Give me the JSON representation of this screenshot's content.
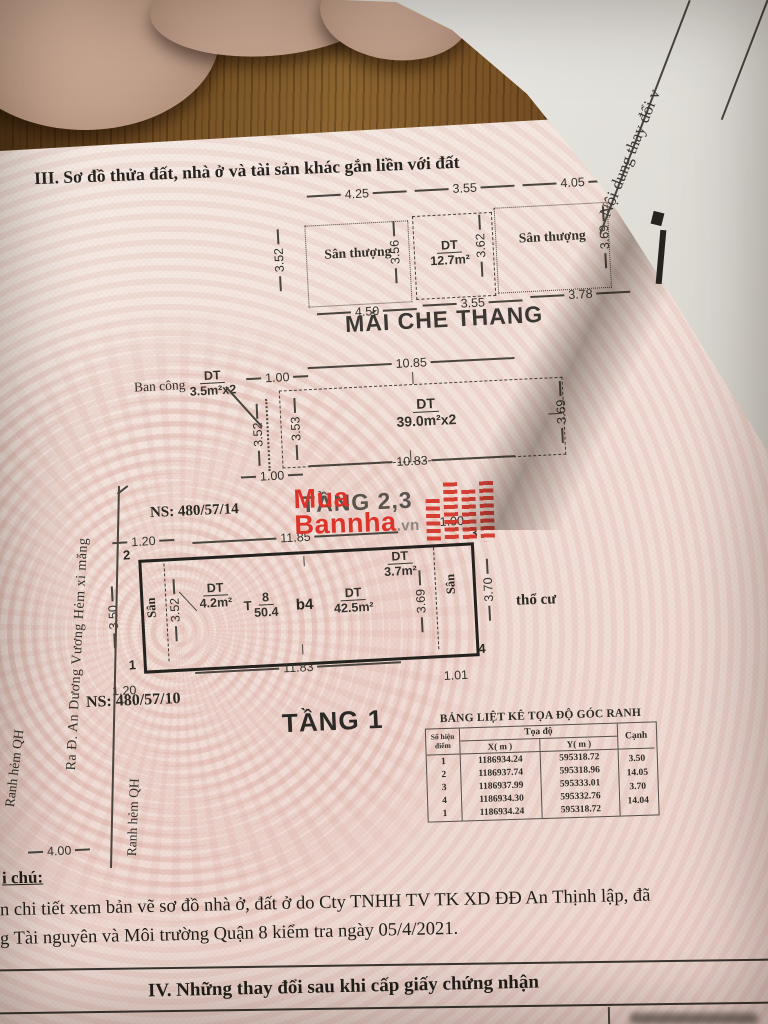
{
  "photo": {
    "next_page_vertical_text": "Nội dung thay đổi v"
  },
  "doc": {
    "section3_title": "III. Sơ đồ thửa đất, nhà ở và tài sản khác gắn liền với đất",
    "section4_title": "IV. Những thay đổi sau khi cấp giấy chứng nhận",
    "note_label": "i chú:",
    "note_line1": "n chi tiết xem bản vẽ sơ đồ nhà ở, đất ở do Cty TNHH TV TK XD ĐĐ An Thịnh lập, đã",
    "note_line2": "g Tài nguyên và Môi trường Quận 8 kiểm tra ngày 05/4/2021."
  },
  "roof": {
    "title": "MÁI CHE THANG",
    "left_label": "Sân thượng",
    "right_label": "Sân thượng",
    "dt": "DT",
    "area": "12.7m²",
    "d_top_left": "4.25",
    "d_top_mid": "3.55",
    "d_top_right": "4.05",
    "d_left": "3.52",
    "d_mid_left": "3.56",
    "d_mid_right": "3.62",
    "d_right": "3.69",
    "d_bot_left": "4.50",
    "d_bot_mid": "3.55",
    "d_bot_right": "3.78"
  },
  "floor23": {
    "title": "TẦNG 2,3",
    "balcony": "Ban công",
    "dt": "DT",
    "balcony_area": "3.5m²x2",
    "area": "39.0m²x2",
    "d_top_offset": "1.00",
    "d_top": "10.85",
    "d_left_outer": "3.52",
    "d_left_inner": "3.53",
    "d_right": "3.69",
    "d_bottom": "10.83",
    "d_bottom_offset": "1.00"
  },
  "floor1": {
    "title": "TẦNG 1",
    "ns_top": "NS: 480/57/14",
    "ns_bottom": "NS: 480/57/10",
    "land_type": "thổ cư",
    "street": "Ra Đ. An Dương Vương  Hẻm xi măng",
    "ranh1": "Ranh hẻm QH",
    "ranh2": "Ranh hẻm QH",
    "alley_w": "4.00",
    "san_left": "Sân",
    "san_right": "Sân",
    "dt": "DT",
    "area_left": "4.2m²",
    "house_no_prefix": "T",
    "house_no_top": "8",
    "house_no_bottom": "50.4",
    "block": "b4",
    "area_main": "42.5m²",
    "area_right": "3.7m²",
    "d_top": "11.85",
    "d_bottom": "11.83",
    "d_left_offset_top": "1.20",
    "d_left_offset_bottom": "1.20",
    "d_right_offset_top": "1.00",
    "d_right_offset_bottom": "1.01",
    "d_left": "3.50",
    "d_inner_left": "3.52",
    "d_inner_right": "3.69",
    "d_right": "3.70",
    "c1": "1",
    "c2": "2",
    "c3": "3",
    "c4": "4"
  },
  "table": {
    "title": "BẢNG LIỆT KÊ TỌA ĐỘ GÓC RANH",
    "h_point1": "Số hiệu",
    "h_point2": "điểm",
    "h_coord": "Tọa độ",
    "h_x": "X( m )",
    "h_y": "Y( m )",
    "h_edge": "Cạnh",
    "rows": [
      {
        "p": "1",
        "x": "1186934.24",
        "y": "595318.72"
      },
      {
        "p": "2",
        "x": "1186937.74",
        "y": "595318.96"
      },
      {
        "p": "3",
        "x": "1186937.99",
        "y": "595333.01"
      },
      {
        "p": "4",
        "x": "1186934.30",
        "y": "595332.76"
      },
      {
        "p": "1",
        "x": "1186934.24",
        "y": "595318.72"
      }
    ],
    "edges": [
      "3.50",
      "14.05",
      "3.70",
      "14.04"
    ]
  },
  "watermark": {
    "l1": "Mua",
    "l2": "Bannha",
    "suffix": ".vn"
  }
}
